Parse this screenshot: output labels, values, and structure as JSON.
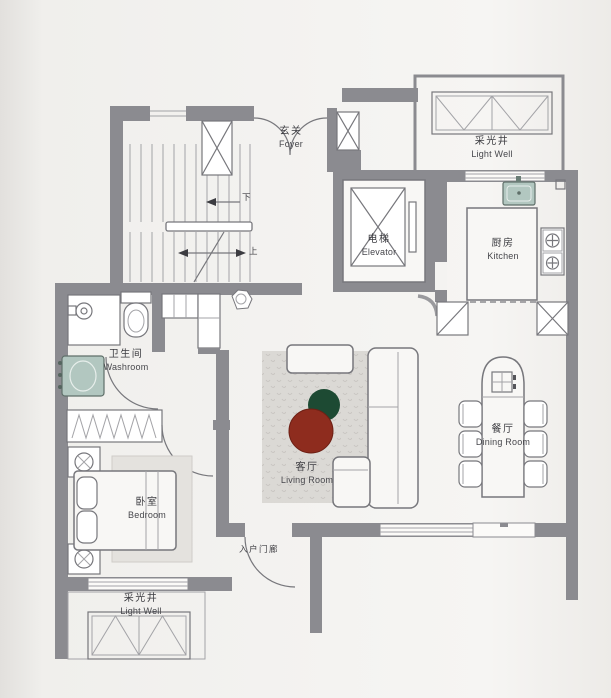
{
  "plan_title": "apartment-floor-plan",
  "rooms": {
    "foyer": {
      "zh": "玄关",
      "en": "Foyer"
    },
    "light_well_top": {
      "zh": "采光井",
      "en": "Light Well"
    },
    "elevator": {
      "zh": "电梯",
      "en": "Elevator"
    },
    "kitchen": {
      "zh": "厨房",
      "en": "Kitchen"
    },
    "washroom": {
      "zh": "卫生间",
      "en": "Washroom"
    },
    "living_room": {
      "zh": "客厅",
      "en": "Living Room"
    },
    "dining_room": {
      "zh": "餐厅",
      "en": "Dining Room"
    },
    "bedroom": {
      "zh": "卧室",
      "en": "Bedroom"
    },
    "entrance_porch": {
      "zh": "入户门廊",
      "en": ""
    },
    "light_well_bottom": {
      "zh": "采光井",
      "en": "Light Well"
    }
  },
  "stairs": {
    "down_label": "下",
    "up_label": "上"
  },
  "colors": {
    "wall_gray": "#8b8b90",
    "coffee_table_red": "#8e2c1e",
    "side_table_green": "#1d4a33",
    "sink_green": "#b2c7c0"
  }
}
